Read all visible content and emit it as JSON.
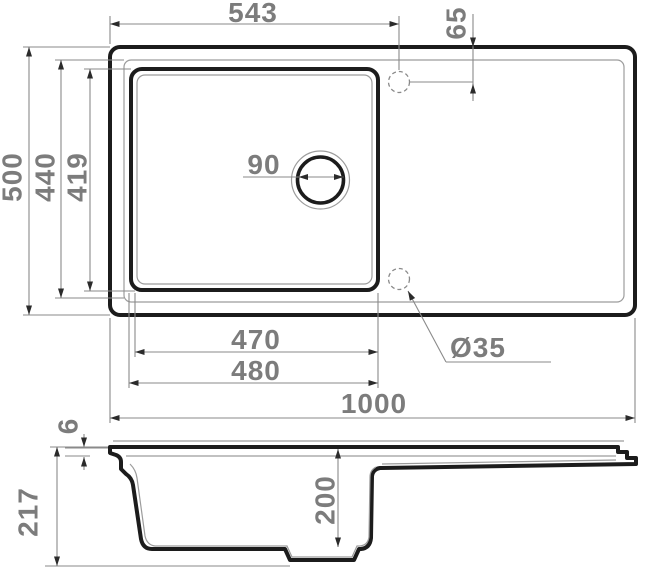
{
  "drawing": {
    "type": "sink-technical-drawing",
    "views": [
      "top-plan-view",
      "side-section-view"
    ]
  },
  "colors": {
    "background": "#ffffff",
    "outline_dark": "#1c1c1c",
    "object_thin_line": "#9c9c9c",
    "dimension_line": "#8a8a8a",
    "dimension_text": "#7c7c7c",
    "arrowhead": "#2b2b2b"
  },
  "top_view": {
    "dims": {
      "edge_to_tap_center": "543",
      "tap_center_offset": "65",
      "outer_depth": "500",
      "rim_depth": "440",
      "bowl_depth": "419",
      "drain_diameter": "90",
      "bowl_width": "470",
      "bowl_outer_width": "480",
      "tap_hole_diameter": "Ø35",
      "total_width": "1000"
    }
  },
  "side_view": {
    "dims": {
      "rim_lip_height": "6",
      "total_height": "217",
      "bowl_inner_depth": "200"
    }
  }
}
